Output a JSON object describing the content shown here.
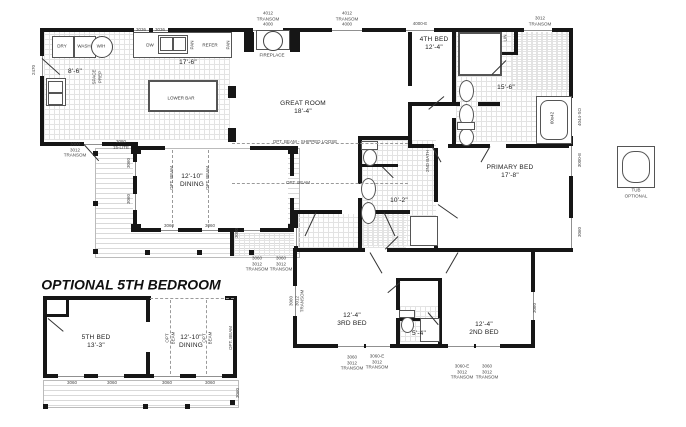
{
  "drawing": {
    "type": "floor-plan",
    "section_title": "OPTIONAL 5TH BEDROOM",
    "detail_caption": "TUB\nOPTIONAL"
  },
  "colors": {
    "wall": "#161616",
    "label": "#222222",
    "tile_line": "#e3e3e3",
    "deck_line": "#d9d9d9"
  },
  "labels": [
    {
      "t": "3036",
      "x": 141,
      "y": 30,
      "s": "t"
    },
    {
      "t": "3036",
      "x": 160,
      "y": 30,
      "s": "t"
    },
    {
      "t": "4012\nTRANSOM\n4000",
      "x": 268,
      "y": 19,
      "s": "t"
    },
    {
      "t": "4012\nTRANSOM\n4000",
      "x": 347,
      "y": 19,
      "s": "t"
    },
    {
      "t": "4000-E",
      "x": 420,
      "y": 24,
      "s": "t"
    },
    {
      "t": "3012\nTRANSOM",
      "x": 540,
      "y": 21,
      "s": "t"
    },
    {
      "t": "2470",
      "x": 34,
      "y": 70,
      "s": "t",
      "r": 1
    },
    {
      "t": "SPACE\nPREP",
      "x": 97,
      "y": 77,
      "s": "t",
      "r": 1
    },
    {
      "t": "DRY",
      "x": 62,
      "y": 46,
      "s": "f"
    },
    {
      "t": "WASH",
      "x": 84,
      "y": 46,
      "s": "f"
    },
    {
      "t": "W/H",
      "x": 101,
      "y": 46,
      "s": "f"
    },
    {
      "t": "DW",
      "x": 150,
      "y": 45,
      "s": "f"
    },
    {
      "t": "PAN",
      "x": 192,
      "y": 45,
      "s": "f",
      "r": 1
    },
    {
      "t": "REFER",
      "x": 210,
      "y": 45,
      "s": "f"
    },
    {
      "t": "PAN",
      "x": 228,
      "y": 45,
      "s": "f",
      "r": 1
    },
    {
      "t": "8'-6\"",
      "x": 75,
      "y": 72,
      "s": "room"
    },
    {
      "t": "17'-6\"",
      "x": 188,
      "y": 63,
      "s": "room"
    },
    {
      "t": "LOWER BAR",
      "x": 181,
      "y": 98,
      "s": "f"
    },
    {
      "t": "FIREPLACE",
      "x": 272,
      "y": 55,
      "s": "f"
    },
    {
      "t": "GREAT ROOM\n18'-4\"",
      "x": 303,
      "y": 108,
      "s": "room"
    },
    {
      "t": "4TH BED\n12'-4\"",
      "x": 434,
      "y": 44,
      "s": "room"
    },
    {
      "t": "LIN",
      "x": 505,
      "y": 38,
      "s": "f",
      "r": 1
    },
    {
      "t": "15'-6\"",
      "x": 506,
      "y": 88,
      "s": "room"
    },
    {
      "t": "60x42",
      "x": 552,
      "y": 118,
      "s": "f",
      "r": 1
    },
    {
      "t": "4044-SO",
      "x": 580,
      "y": 117,
      "s": "t",
      "r": 1
    },
    {
      "t": "3000-E",
      "x": 580,
      "y": 160,
      "s": "t",
      "r": 1
    },
    {
      "t": "3060",
      "x": 580,
      "y": 232,
      "s": "t",
      "r": 1
    },
    {
      "t": "PRIMARY BED\n17'-8\"",
      "x": 510,
      "y": 172,
      "s": "room"
    },
    {
      "t": "2ND BATH",
      "x": 428,
      "y": 161,
      "s": "t",
      "r": 1
    },
    {
      "t": "10'-2\"",
      "x": 399,
      "y": 201,
      "s": "room"
    },
    {
      "t": "12'-10\"\nDINING",
      "x": 192,
      "y": 181,
      "s": "room"
    },
    {
      "t": "OPT. BEAM",
      "x": 172,
      "y": 178,
      "s": "t",
      "r": 1
    },
    {
      "t": "OPT. BEAM",
      "x": 208,
      "y": 178,
      "s": "t",
      "r": 1
    },
    {
      "t": "OPT. BEAM - SHIPPED LOOSE",
      "x": 305,
      "y": 142,
      "s": "t"
    },
    {
      "t": "OPT. BEAM",
      "x": 298,
      "y": 183,
      "s": "t"
    },
    {
      "t": "3060",
      "x": 129,
      "y": 163,
      "s": "t",
      "r": 1
    },
    {
      "t": "3060",
      "x": 129,
      "y": 199,
      "s": "t",
      "r": 1
    },
    {
      "t": "3060",
      "x": 169,
      "y": 226,
      "s": "t"
    },
    {
      "t": "3060",
      "x": 210,
      "y": 226,
      "s": "t"
    },
    {
      "t": "3000\n3012\nTRANSOM",
      "x": 75,
      "y": 150,
      "s": "t"
    },
    {
      "t": "3080",
      "x": 121,
      "y": 142,
      "s": "t"
    },
    {
      "t": "15-LITE",
      "x": 121,
      "y": 148,
      "s": "t"
    },
    {
      "t": "3080",
      "x": 237,
      "y": 233,
      "s": "t",
      "r": 1
    },
    {
      "t": "3060\n3012\nTRANSOM",
      "x": 257,
      "y": 264,
      "s": "t"
    },
    {
      "t": "3060\n3012\nTRANSOM",
      "x": 281,
      "y": 264,
      "s": "t"
    },
    {
      "t": "3060\n3012\nTRANSOM",
      "x": 297,
      "y": 301,
      "s": "t",
      "r": 1
    },
    {
      "t": "12'-4\"\n3RD BED",
      "x": 352,
      "y": 320,
      "s": "room"
    },
    {
      "t": "5'-4\"",
      "x": 419,
      "y": 334,
      "s": "room"
    },
    {
      "t": "12'-4\"\n2ND BED",
      "x": 484,
      "y": 329,
      "s": "room"
    },
    {
      "t": "3060\n3012\nTRANSOM",
      "x": 352,
      "y": 363,
      "s": "t"
    },
    {
      "t": "3060-E\n3012\nTRANSOM",
      "x": 377,
      "y": 362,
      "s": "t"
    },
    {
      "t": "3060-E\n3012\nTRANSOM",
      "x": 462,
      "y": 372,
      "s": "t"
    },
    {
      "t": "3060\n3012\nTRANSOM",
      "x": 487,
      "y": 372,
      "s": "t"
    },
    {
      "t": "3060",
      "x": 535,
      "y": 308,
      "s": "t",
      "r": 1
    },
    {
      "t": "TUB\nOPTIONAL",
      "x": 636,
      "y": 193,
      "s": "t"
    },
    {
      "t": "5TH BED\n13'-3\"",
      "x": 96,
      "y": 342,
      "s": "room"
    },
    {
      "t": "12'-10\"\nDINING",
      "x": 191,
      "y": 342,
      "s": "room"
    },
    {
      "t": "OPT\nBEAM",
      "x": 170,
      "y": 338,
      "s": "t",
      "r": 1
    },
    {
      "t": "OPT\nBEAM",
      "x": 207,
      "y": 338,
      "s": "t",
      "r": 1
    },
    {
      "t": "OPT. BEAM",
      "x": 231,
      "y": 338,
      "s": "t",
      "r": 1
    },
    {
      "t": "3060",
      "x": 72,
      "y": 383,
      "s": "t"
    },
    {
      "t": "3060",
      "x": 112,
      "y": 383,
      "s": "t"
    },
    {
      "t": "3060",
      "x": 167,
      "y": 383,
      "s": "t"
    },
    {
      "t": "3060",
      "x": 210,
      "y": 383,
      "s": "t"
    },
    {
      "t": "3060",
      "x": 238,
      "y": 393,
      "s": "t",
      "r": 1
    }
  ]
}
